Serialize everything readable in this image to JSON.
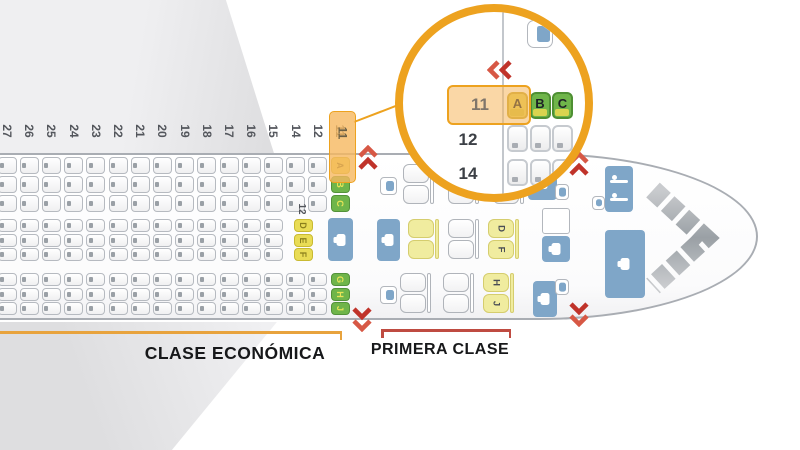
{
  "palette": {
    "accent_orange": "#EDA21F",
    "highlight_fill": "rgba(246,184,95,0.8)",
    "seat_yellow": "#E9DC55",
    "seat_green": "#6FB54A",
    "first_class_yellow": "#F0EC9F",
    "galley_blue": "#7FA6C8",
    "exit_red_dark": "#C0332A",
    "exit_red_light": "#D75845",
    "bracket_economy": "#E8A33D",
    "bracket_first": "#BF4B41"
  },
  "sections": {
    "economy_label": "CLASE ECONÓMICA",
    "first_class_label": "PRIMERA CLASE"
  },
  "economy": {
    "row_numbers": [
      "27",
      "26",
      "25",
      "24",
      "23",
      "22",
      "21",
      "20",
      "19",
      "18",
      "17",
      "16",
      "15",
      "14",
      "12",
      "11"
    ],
    "highlighted_row": "11",
    "mid_section_front_row": "12",
    "front_seats_abc": [
      "A",
      "B",
      "C"
    ],
    "front_seats_def": [
      "D",
      "E",
      "F"
    ],
    "front_seats_ghj": [
      "G",
      "H",
      "J"
    ]
  },
  "first_class": {
    "mid_pair_letters": [
      "D",
      "F"
    ],
    "bottom_pair_letters": [
      "H",
      "J"
    ]
  },
  "inset": {
    "rows": [
      {
        "number": "11",
        "seats": [
          "A",
          "B",
          "C"
        ],
        "highlighted": true
      },
      {
        "number": "12",
        "seats": [
          "",
          "",
          ""
        ],
        "highlighted": false
      },
      {
        "number": "14",
        "seats": [
          "",
          "",
          ""
        ],
        "highlighted": false
      }
    ]
  },
  "icons": [
    "galley-icon",
    "lavatory-icon",
    "crew-seat-icon",
    "exit-arrows-icon",
    "cockpit-icon",
    "magnifier-circle"
  ]
}
